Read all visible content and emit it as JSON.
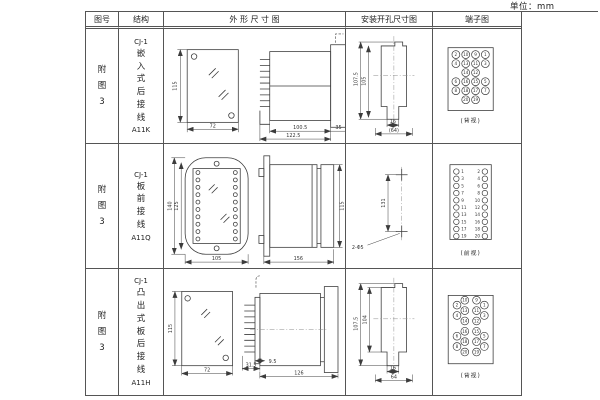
{
  "unit_label": "单位：mm",
  "table": {
    "headers": {
      "fig_no": "图号",
      "structure": "结构",
      "outline": "外 形 尺 寸 图",
      "mounting": "安装开孔尺寸图",
      "terminal": "端子图"
    },
    "rows": [
      {
        "fig_no": "附图3",
        "model": "CJ-1",
        "mount_type": "嵌入式后接线",
        "code": "A11K",
        "outline": {
          "front_height": "115",
          "front_width": "72",
          "body_depth": "100.5",
          "total_depth": "122.5",
          "flange_depth": "35"
        },
        "mounting": {
          "outer_height": "107.5",
          "inner_height": "105",
          "slot_width": "16",
          "hole_span": "(64)"
        },
        "terminal": {
          "style": "grid",
          "view_label": "(背视)",
          "rows": [
            [
              "2",
              "10",
              "9",
              "1"
            ],
            [
              "4",
              "13",
              "11",
              "3"
            ],
            [
              "",
              "14",
              "12",
              ""
            ],
            [
              "6",
              "16",
              "15",
              "5"
            ],
            [
              "8",
              "18",
              "17",
              "7"
            ],
            [
              "",
              "20",
              "19",
              ""
            ]
          ]
        }
      },
      {
        "fig_no": "附图3",
        "model": "CJ-1",
        "mount_type": "板前接线",
        "code": "A11Q",
        "outline": {
          "front_outer_height": "140",
          "front_inner_height": "125",
          "front_width": "105",
          "body_depth": "156",
          "body_height": "115"
        },
        "mounting": {
          "hole_spacing": "131",
          "hole_note": "2-Φ5"
        },
        "terminal": {
          "style": "columns",
          "view_label": "(前视)",
          "left": [
            "1",
            "3",
            "5",
            "7",
            "9",
            "11",
            "13",
            "15",
            "17",
            "19"
          ],
          "right": [
            "2",
            "4",
            "6",
            "8",
            "10",
            "12",
            "14",
            "16",
            "18",
            "20"
          ]
        }
      },
      {
        "fig_no": "附图3",
        "model": "CJ-1",
        "mount_type": "凸出式板后接线",
        "code": "A11H",
        "outline": {
          "front_height": "115",
          "front_width": "72",
          "plate_offset": "9.5",
          "pin_depth": "31.5",
          "body_depth": "126"
        },
        "mounting": {
          "outer_height": "107.5",
          "inner_height": "104",
          "slot_width": "16",
          "hole_span": "64"
        },
        "terminal": {
          "style": "grid-staggered",
          "view_label": "(背视)",
          "rows": [
            [
              "2",
              "10",
              "9",
              "1"
            ],
            [
              "4",
              "13",
              "11",
              "3"
            ],
            [
              "",
              "14",
              "12",
              ""
            ],
            [
              "6",
              "16",
              "15",
              "5"
            ],
            [
              "8",
              "18",
              "17",
              "7"
            ],
            [
              "",
              "20",
              "19",
              ""
            ]
          ]
        }
      }
    ]
  }
}
